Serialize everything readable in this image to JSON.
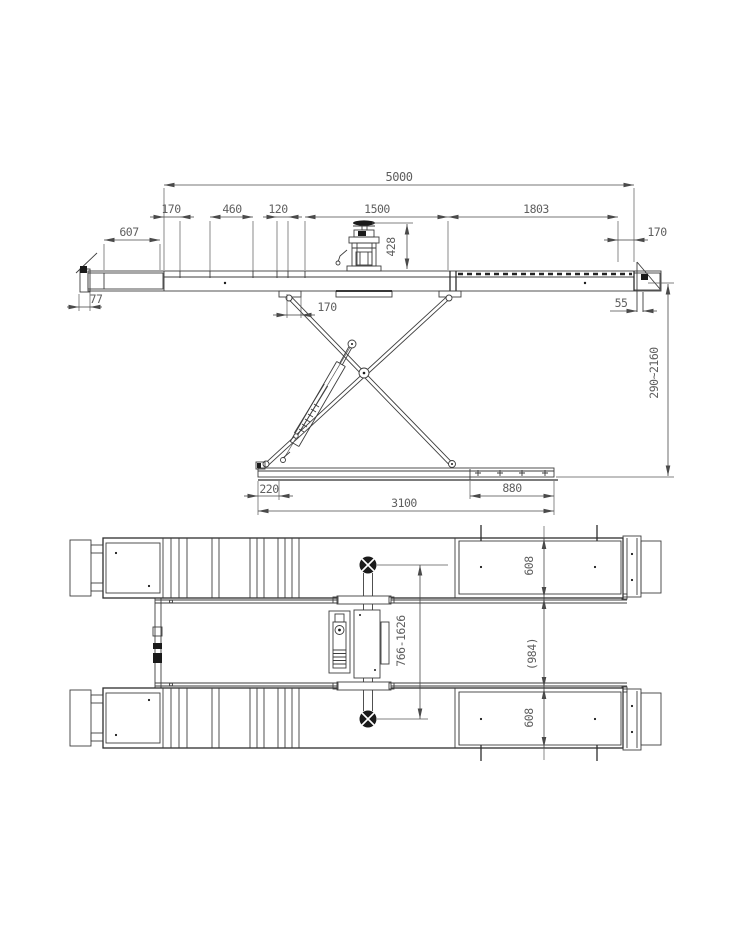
{
  "drawing": {
    "side_view": {
      "overall_length": "5000",
      "seg_left_170": "170",
      "seg_460": "460",
      "seg_120": "120",
      "seg_1500": "1500",
      "seg_1803": "1803",
      "left_ramp_607": "607",
      "right_end_170": "170",
      "pump_height_428": "428",
      "left_flap_77": "77",
      "under_platform_170": "170",
      "right_flap_55": "55",
      "lift_height_range": "290~2160",
      "base_offset_220": "220",
      "base_roller_880": "880",
      "base_length_3100": "3100"
    },
    "plan_view": {
      "runway_width_top": "608",
      "track_gap": "(984)",
      "runway_width_bottom": "608",
      "crossbar_stroke_range": "766-1626"
    },
    "colors": {
      "line": "#3d3d3d",
      "line_heavy": "#1c1c1c",
      "dimension": "#4a4a4a",
      "dim_text": "#5f5f5f",
      "background": "#ffffff",
      "solid_fill": "#1a1a1a"
    }
  }
}
